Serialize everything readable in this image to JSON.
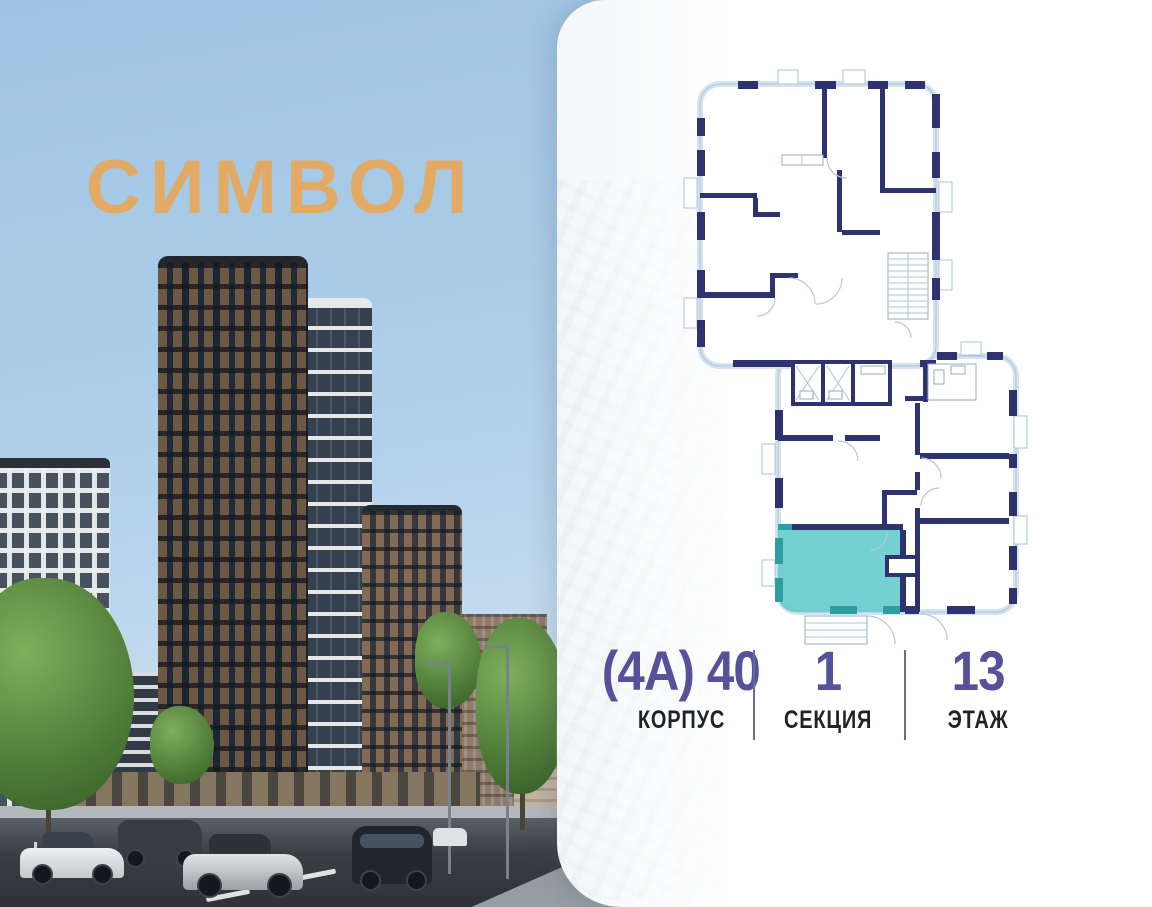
{
  "brand": {
    "logo_text": "СИМВОЛ",
    "logo_color": "#e2aa64"
  },
  "plan": {
    "name": "floor-plan",
    "highlight_color": "#68cdce",
    "highlight_accent_color": "#2d9fa3",
    "wall_color": "#2e336f",
    "outline_color": "#a9c4da"
  },
  "details": {
    "value_color": "#55519a",
    "building": {
      "value": "(4А) 40",
      "label": "КОРПУС"
    },
    "section": {
      "value": "1",
      "label": "СЕКЦИЯ"
    },
    "floor": {
      "value": "13",
      "label": "ЭТАЖ"
    }
  }
}
